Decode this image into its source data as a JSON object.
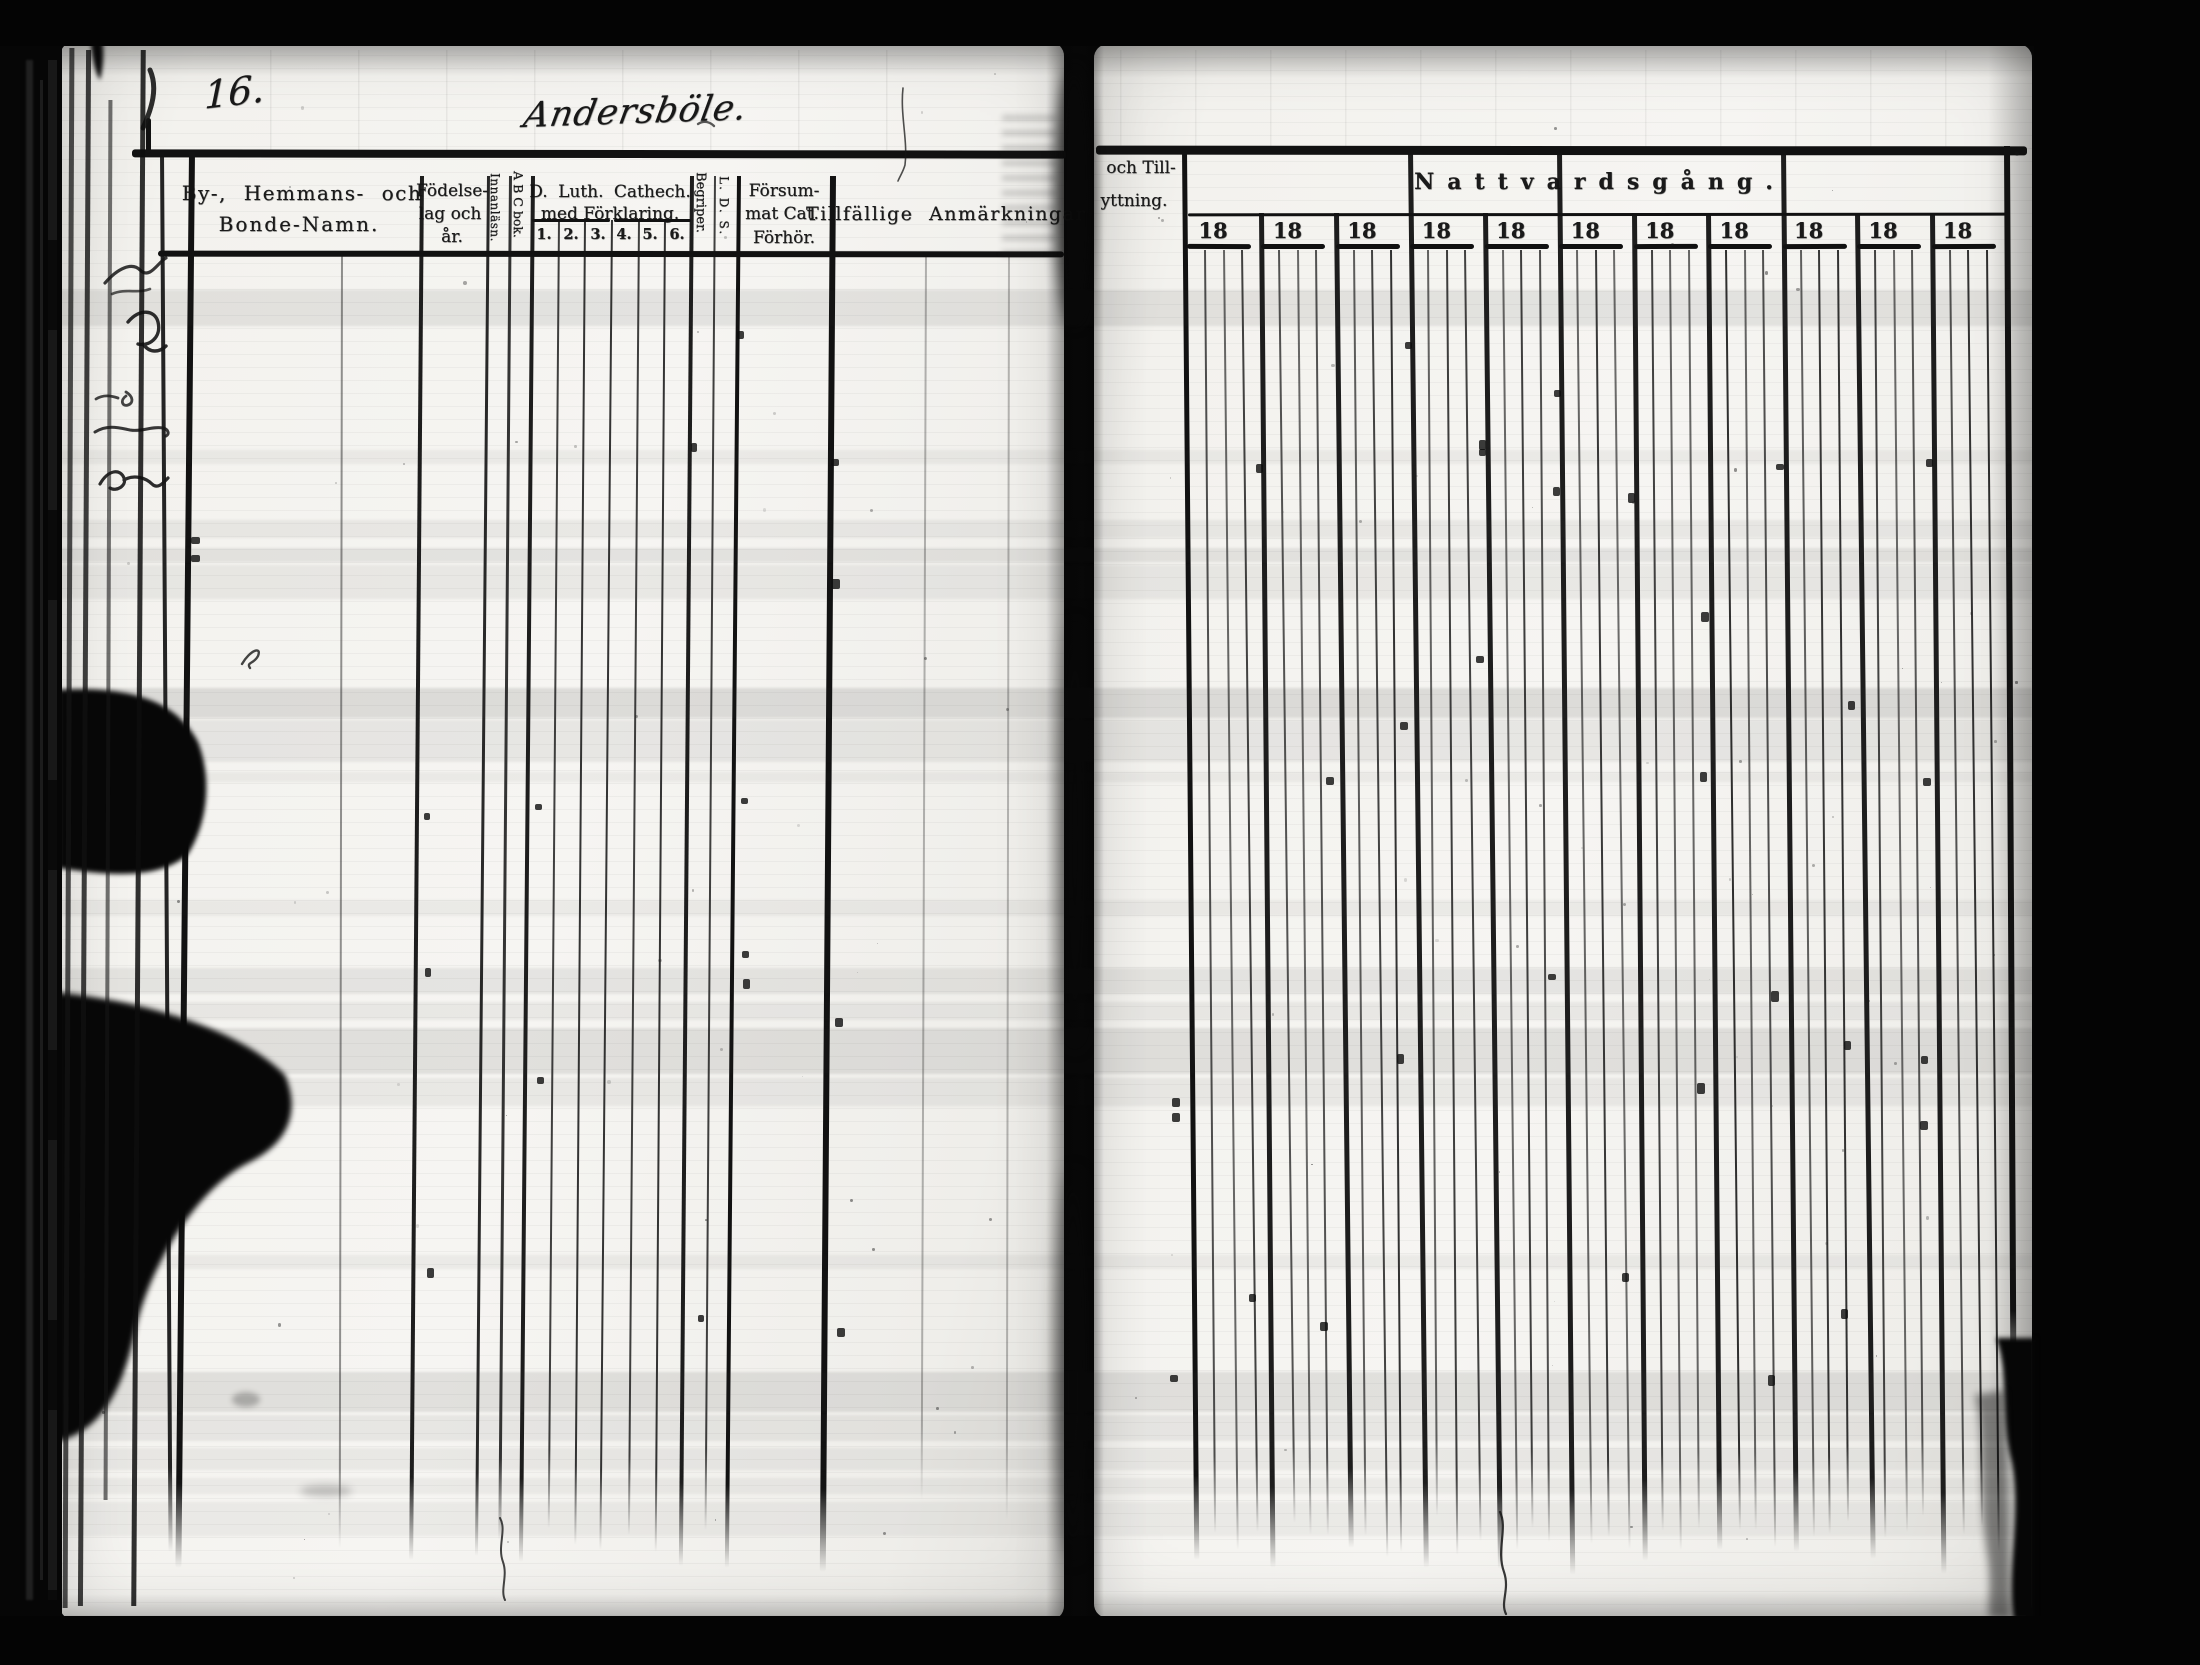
{
  "scan": {
    "left_page_number": "16.",
    "village_title": "Andersböle.",
    "marginalia_note": "illegible cursive fragments on protruding edge of previous leaf"
  },
  "table": {
    "name_header_line1": "By-, Hemmans- och",
    "name_header_line2": "Bonde-Namn.",
    "birth_line1": "Födelse-",
    "birth_line2": "lag och",
    "birth_line3": "år.",
    "reading_rot": "Innanläsn.",
    "abc_rot": "A B C bok.",
    "cat_line1": "D. Luth. Cathech.",
    "cat_line2": "med Förklaring.",
    "cat_grades": [
      "1.",
      "2.",
      "3.",
      "4.",
      "5.",
      "6."
    ],
    "begriper_rot": "Begriper.",
    "lds_rot": "L. D. S.",
    "missed_line1": "Försum-",
    "missed_line2": "mat Cat.",
    "missed_line3": "Förhör.",
    "remarks_header": "Tillfällige Anmärkningar",
    "moving_line1": "och Till-",
    "moving_line2": "yttning."
  },
  "communion": {
    "title": "Nattvardsgång.",
    "year_groups": [
      "18",
      "18",
      "18",
      "18",
      "18",
      "18",
      "18",
      "18",
      "18",
      "18",
      "18"
    ]
  },
  "colors": {
    "paper": "#f3f2ee",
    "ink": "#141414",
    "film": "#050505"
  }
}
